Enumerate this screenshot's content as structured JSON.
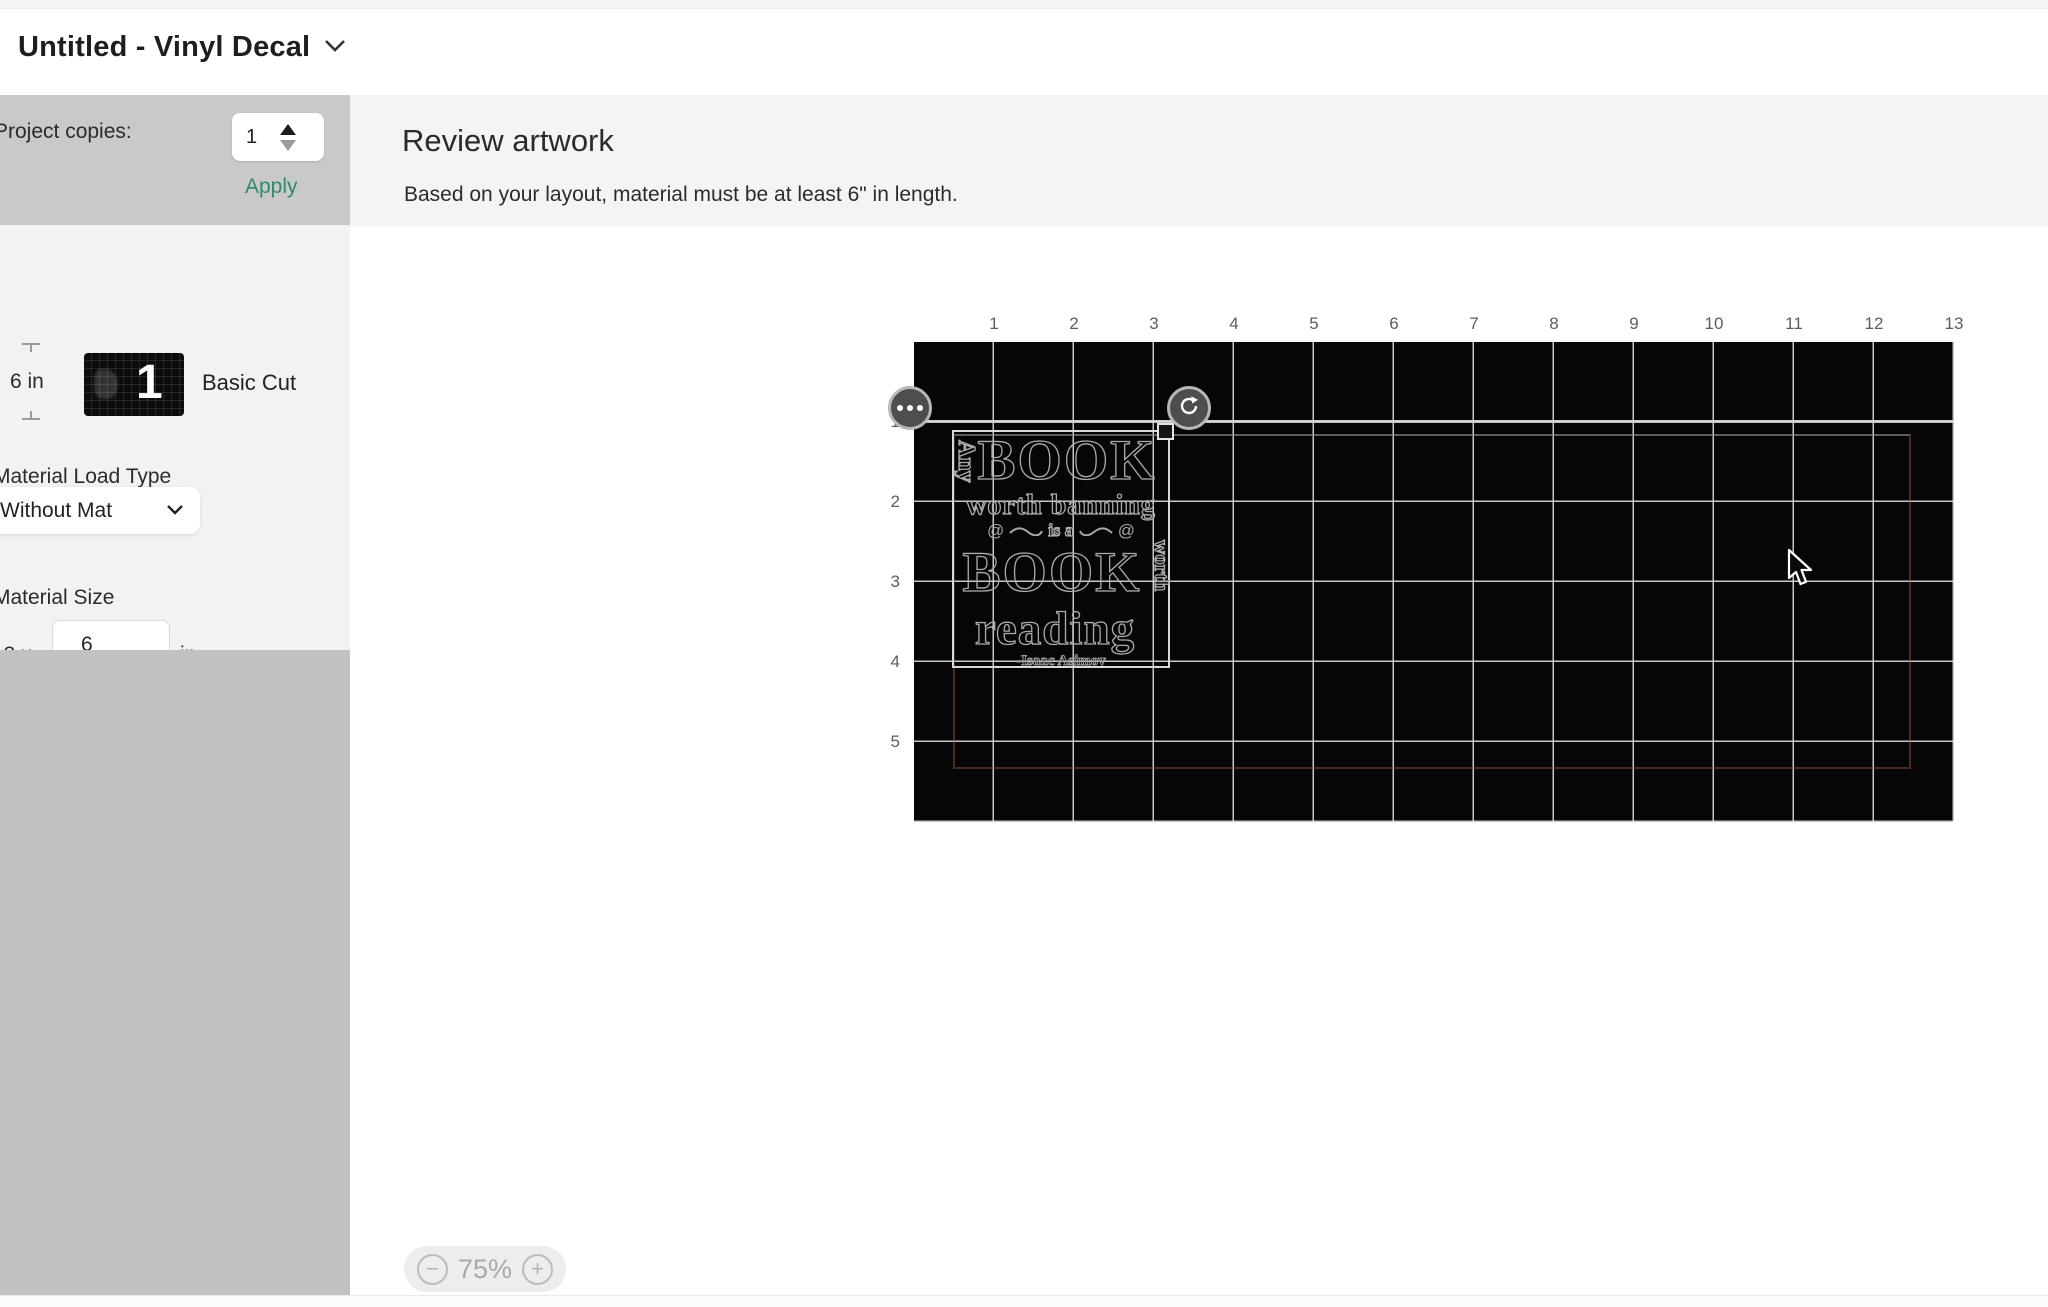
{
  "titlebar": {
    "title": "Untitled - Vinyl Decal"
  },
  "sidebar": {
    "project_copies_label": "Project copies:",
    "copies_value": "1",
    "apply_label": "Apply",
    "material_length_label": "6 in",
    "mat_thumbnail_number": "1",
    "cut_type_label": "Basic Cut",
    "material_load_type_label": "Material Load Type",
    "material_load_type_value": "Without Mat",
    "material_size_label": "Material Size",
    "material_width_prefix": "13 x",
    "material_length_value": "6",
    "material_unit": "in",
    "mirror_label": "Mirror"
  },
  "main": {
    "heading": "Review artwork",
    "subtitle": "Based on your layout, material must be at least 6\" in length."
  },
  "canvas": {
    "ruler_top": [
      "1",
      "2",
      "3",
      "4",
      "5",
      "6",
      "7",
      "8",
      "9",
      "10",
      "11",
      "12",
      "13"
    ],
    "ruler_left": [
      "1",
      "2",
      "3",
      "4",
      "5"
    ],
    "zoom_level": "75%",
    "zoom_out_symbol": "−",
    "zoom_in_symbol": "+",
    "artwork": {
      "vertical_left": "Any",
      "book_top": "BOOK",
      "worth_banning": "worth banning",
      "is_a": "is a",
      "swirl": "@",
      "book_bottom": "BOOK",
      "vertical_right": "worth",
      "reading": "reading",
      "author": "-Isaac Asimov"
    }
  },
  "colors": {
    "apply_link": "#2e8a6e",
    "sidebar_top": "#c9c9c8",
    "sidebar_mid": "#f2f2f1",
    "sidebar_bottom": "#c2c2c1",
    "mat_background": "#060606",
    "boundary_line": "#965c42"
  }
}
